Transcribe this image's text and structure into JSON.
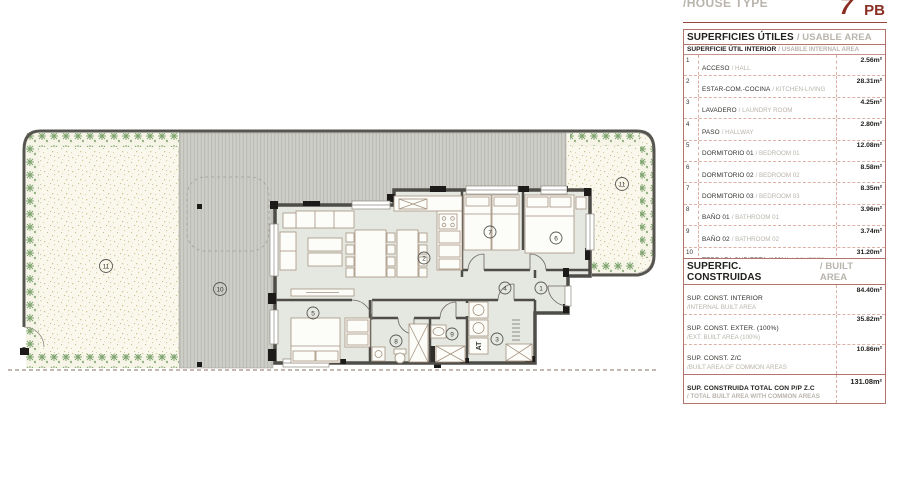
{
  "header": {
    "house_type_label": "/HOUSE TYPE",
    "house_type_number": "7",
    "house_type_suffix": "PB"
  },
  "usable_table": {
    "title_es": "SUPERFICIES ÚTILES",
    "title_en": "/ USABLE AREA",
    "subheader_es": "SUPERFICIE ÚTIL INTERIOR",
    "subheader_en": "/ USABLE INTERNAL AREA",
    "rows": [
      {
        "num": "1",
        "es": "ACCESO",
        "en": "/ HALL",
        "value": "2.56m²"
      },
      {
        "num": "2",
        "es": "ESTAR-COM.-COCINA",
        "en": "/ KITCHEN-LIVING",
        "value": "28.31m²"
      },
      {
        "num": "3",
        "es": "LAVADERO",
        "en": "/ LAUNDRY ROOM",
        "value": "4.25m²"
      },
      {
        "num": "4",
        "es": "PASO",
        "en": "/ HALLWAY",
        "value": "2.80m²"
      },
      {
        "num": "5",
        "es": "DORMITORIO 01",
        "en": "/ BEDROOM 01",
        "value": "12.08m²"
      },
      {
        "num": "6",
        "es": "DORMITORIO 02",
        "en": "/ BEDROOM 02",
        "value": "8.58m²"
      },
      {
        "num": "7",
        "es": "DORMITORIO 03",
        "en": "/ BEDROOM 03",
        "value": "8.35m²"
      },
      {
        "num": "8",
        "es": "BAÑO 01",
        "en": "/ BATHROOM 01",
        "value": "3.96m²"
      },
      {
        "num": "9",
        "es": "BAÑO 02",
        "en": "/ BATHROOM 02",
        "value": "3.74m²"
      },
      {
        "num": "10",
        "es": "TERRAZA CUBIERTA (100%)",
        "en": "/ COVERED TERRACE (100%)",
        "value": "31.20m²"
      },
      {
        "num": "11",
        "es": "JARDÍN DESCUBIERTO (100%)",
        "en": "/ GARDEN (100%)",
        "value": "117.77m²"
      }
    ],
    "total_es": "SUPERFICIE ÚTIL TOTAL",
    "total_en": "/ TOTAL USABLE AREA",
    "total_value": "223.60m²"
  },
  "built_table": {
    "title_es": "SUPERFIC. CONSTRUIDAS",
    "title_en": "/ BUILT AREA",
    "rows": [
      {
        "es": "SUP. CONST. INTERIOR",
        "en": "/INTERNAL BUILT AREA",
        "value": "84.40m²"
      },
      {
        "es": "SUP. CONST. EXTER. (100%)",
        "en": "/EXT. BUILT AREA (100%)",
        "value": "35.82m²"
      },
      {
        "es": "SUP. CONST. Z/C",
        "en": "/BUILT AREA OF COMMON AREAS",
        "value": "10.86m²"
      }
    ],
    "total_es": "SUP. CONSTRUIDA TOTAL CON P/P Z.C",
    "total_en": "/ TOTAL BUILT AREA WITH COMMON AREAS",
    "total_value": "131.08m²"
  },
  "plan": {
    "labels": {
      "r1": "1",
      "r2": "2",
      "r3": "3",
      "r4": "4",
      "r5": "5",
      "r6": "6",
      "r7": "7",
      "r8": "8",
      "r9": "9",
      "r10": "10",
      "r11": "11",
      "at": "AT"
    },
    "colors": {
      "accent_red": "#8a2e24",
      "table_border": "#b3736a",
      "row_dash": "#dcb0a5",
      "muted_gray": "#b9b4ac",
      "wall": "#4f4d48",
      "floor": "#e5e7e1",
      "terrace": "#cdcec7",
      "garden": "#faf8ec",
      "plants": "#7da36f"
    }
  }
}
